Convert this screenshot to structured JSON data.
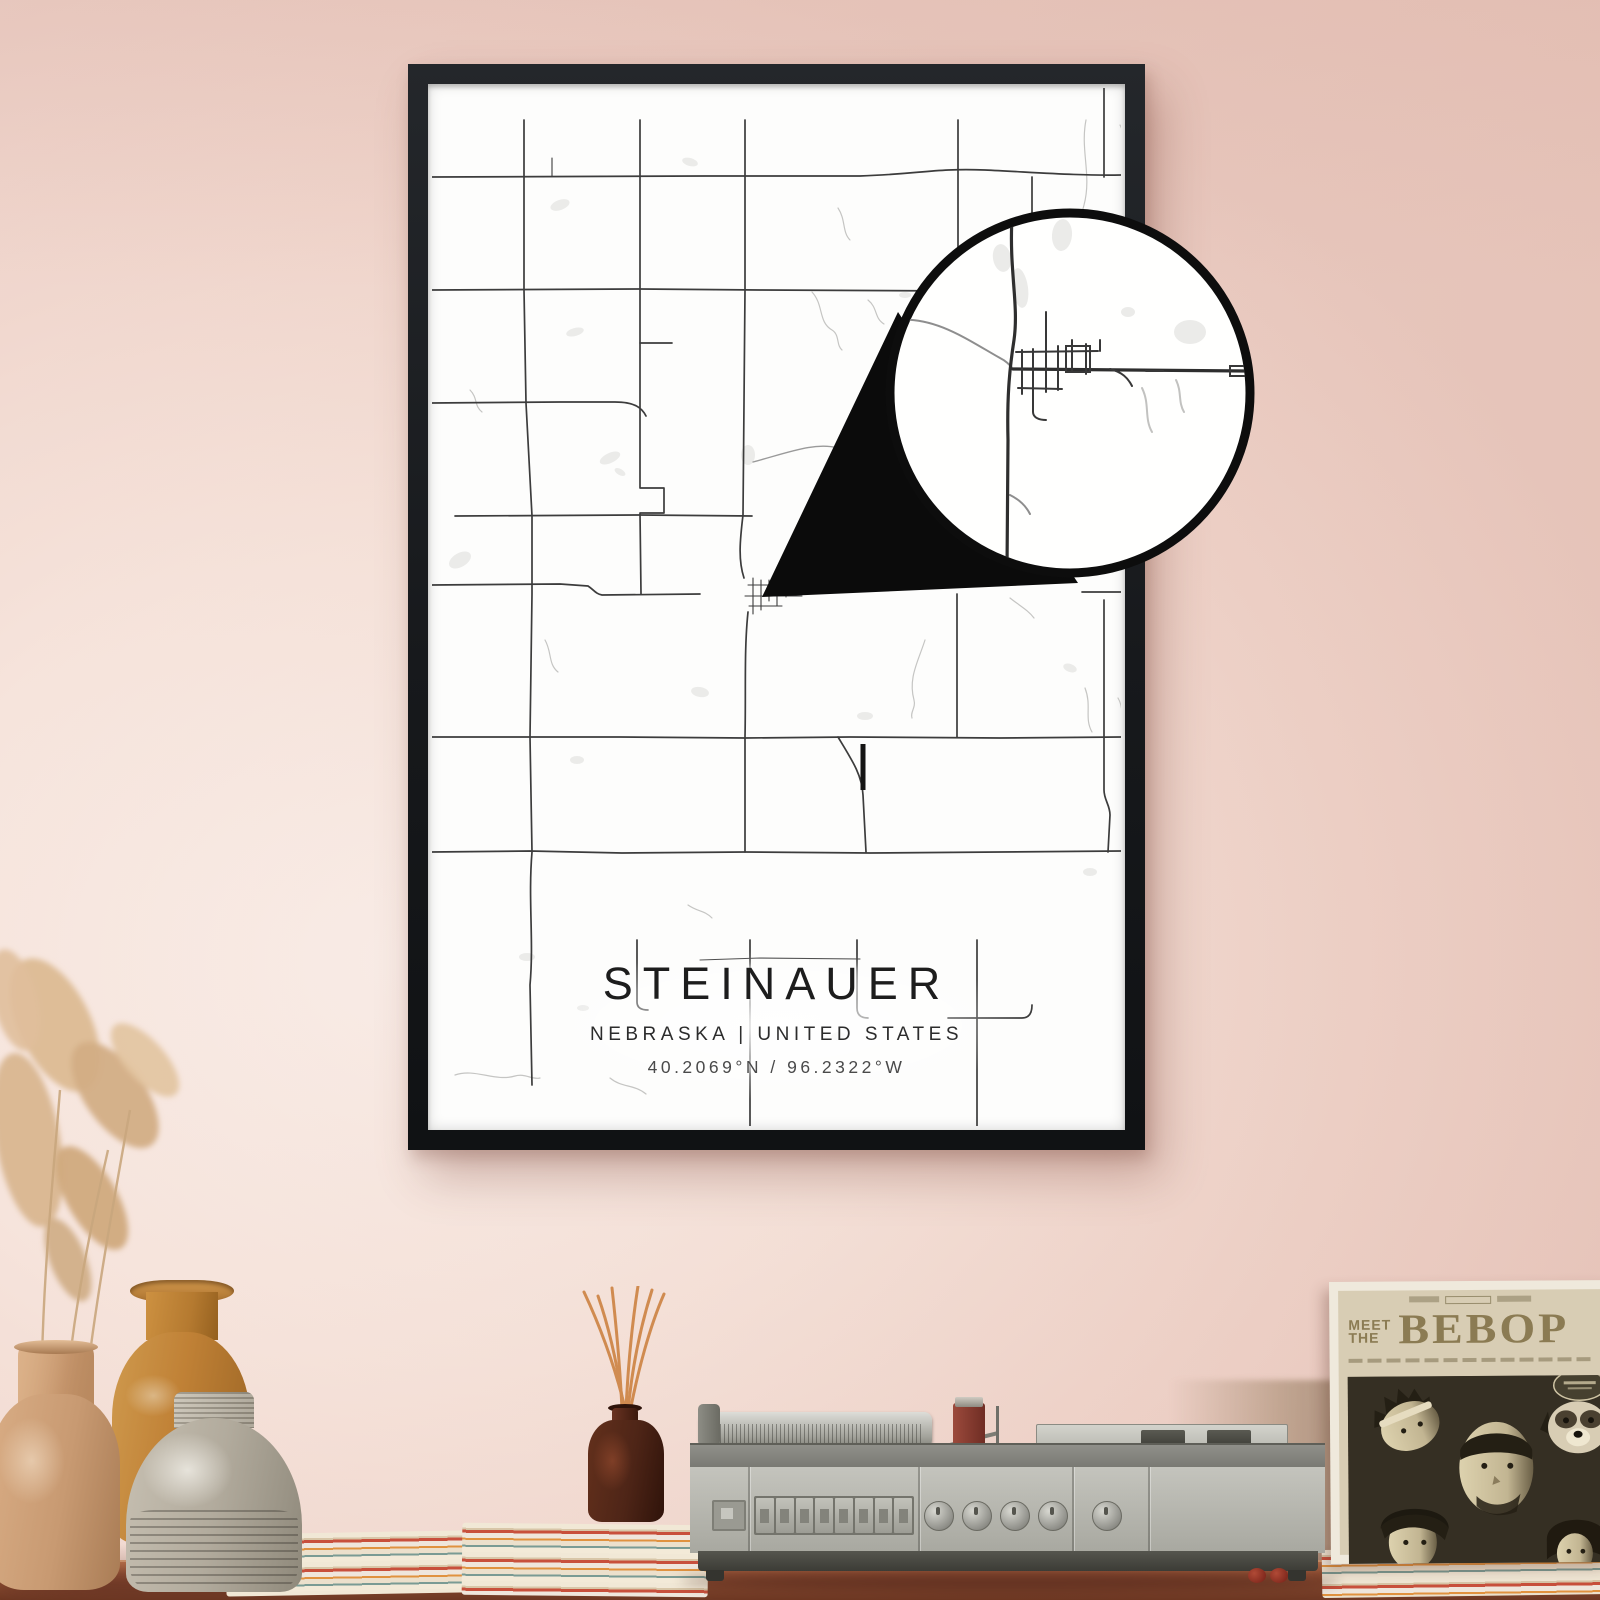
{
  "poster": {
    "title": "STEINAUER",
    "region": "NEBRASKA | UNITED STATES",
    "coordinates": "40.2069°N / 96.2322°W"
  },
  "record_sleeve": {
    "meet": "MEET",
    "the": "THE",
    "album": "BEBOP"
  },
  "colors": {
    "wall": "#f3ddd4",
    "wall_light": "#f9ece6",
    "wall_dark": "#e9c9bf",
    "frame": "#17191c",
    "paper": "#fdfdfc",
    "road": "#3c3c3c",
    "road_light": "#9a9a9a",
    "creek": "#c5c5c3",
    "patch": "#ebebe9",
    "ink": "#1d1d1d",
    "coord_ink": "#4a4a4a",
    "table_wood": "#8f4f34",
    "player_gray": "#b7b7af",
    "sleeve_cream": "#d8cdb4",
    "sleeve_dark": "#352f23",
    "sleeve_ink": "#8b7b53",
    "diffuser_brown": "#4e2517",
    "reed_orange": "#d08b50",
    "grass_tan": "#d9b690"
  }
}
